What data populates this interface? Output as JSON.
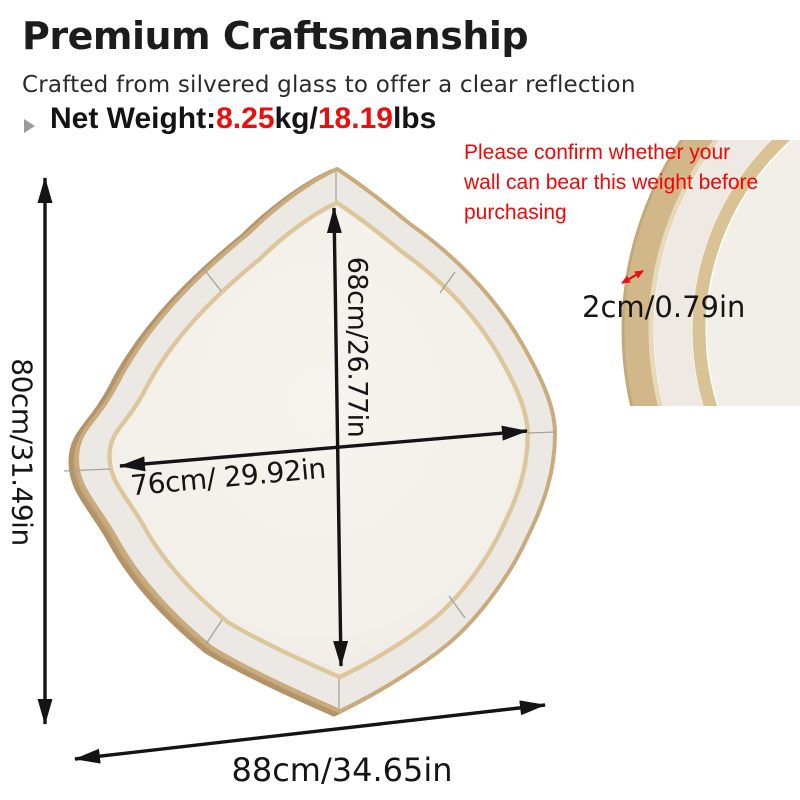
{
  "header": {
    "title": "Premium Craftsmanship",
    "subtitle": "Crafted from silvered glass to offer a clear reflection",
    "net_weight": {
      "label": "Net Weight:",
      "kg_value": "8.25",
      "kg_unit": "kg/",
      "lbs_value": "18.19",
      "lbs_unit": "lbs"
    }
  },
  "warning_note": {
    "line1": "Please confirm whether your",
    "line2": "wall can bear this weight before",
    "line3": "purchasing"
  },
  "dimensions": {
    "overall_height": "80cm/31.49in",
    "inner_height": "68cm/26.77in",
    "inner_width": "76cm/ 29.92in",
    "overall_width": "88cm/34.65in",
    "frame_thickness": "2cm/0.79in"
  },
  "colors": {
    "accent_red": "#e8100c",
    "note_red": "#f50505",
    "gold_frame": "#c9ac7e",
    "gold_trim": "#dcc79c",
    "mirror_border": "#ece9e4",
    "mirror_face": "#f4f1ea",
    "bullet_gray": "#9b9b9b",
    "text_black": "#1c1c1c"
  }
}
